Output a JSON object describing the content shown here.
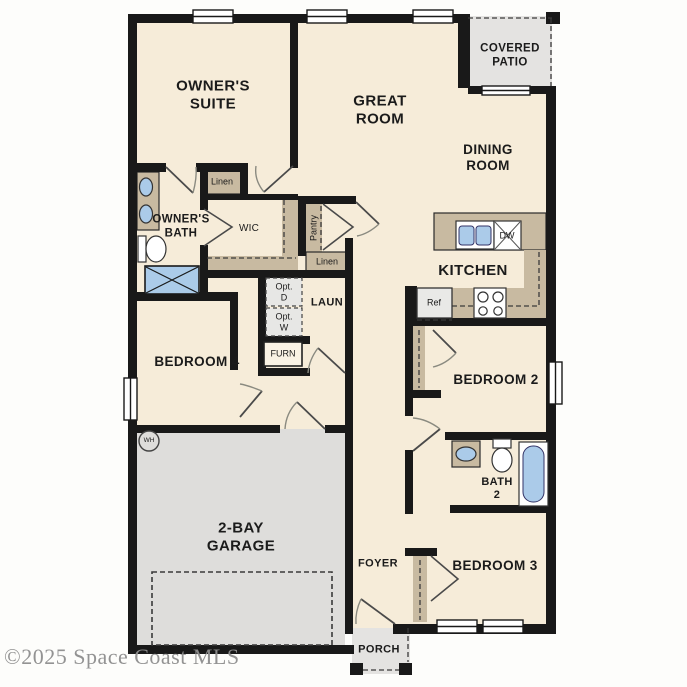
{
  "watermark": "©2025 Space Coast MLS",
  "rooms": {
    "owners_suite": {
      "label": "OWNER'S\nSUITE"
    },
    "great_room": {
      "label": "GREAT\nROOM"
    },
    "covered_patio": {
      "label": "COVERED\nPATIO"
    },
    "dining_room": {
      "label": "DINING\nROOM"
    },
    "kitchen": {
      "label": "KITCHEN"
    },
    "owners_bath": {
      "label": "OWNER'S\nBATH"
    },
    "wic": {
      "label": "WIC"
    },
    "laundry": {
      "label": "LAUN"
    },
    "bedroom_2": {
      "label": "BEDROOM 2"
    },
    "bedroom_3": {
      "label": "BEDROOM 3"
    },
    "bedroom_4": {
      "label": "BEDROOM 4"
    },
    "bath_2": {
      "label": "BATH\n2"
    },
    "garage": {
      "label": "2-BAY\nGARAGE"
    },
    "foyer": {
      "label": "FOYER"
    },
    "porch": {
      "label": "PORCH"
    }
  },
  "closets": {
    "linen_upper": {
      "label": "Linen"
    },
    "linen_lower": {
      "label": "Linen"
    },
    "pantry": {
      "label": "Pantry"
    }
  },
  "appliances": {
    "refrigerator": {
      "label": "Ref"
    },
    "dishwasher": {
      "label": "DW"
    },
    "optional_dryer": {
      "label": "Opt.\nD"
    },
    "optional_washer": {
      "label": "Opt.\nW"
    },
    "furnace": {
      "label": "FURN"
    },
    "water_heater": {
      "label": "WH"
    }
  },
  "colors": {
    "floor": "#f6ecd9",
    "garage_floor": "#dedddb",
    "patio_floor": "#e4e3e1",
    "cabinet_tan": "#c8baa1",
    "fixture_blue": "#abcbe9",
    "wall": "#191919",
    "watermark_gray": "#8e8e8e"
  }
}
